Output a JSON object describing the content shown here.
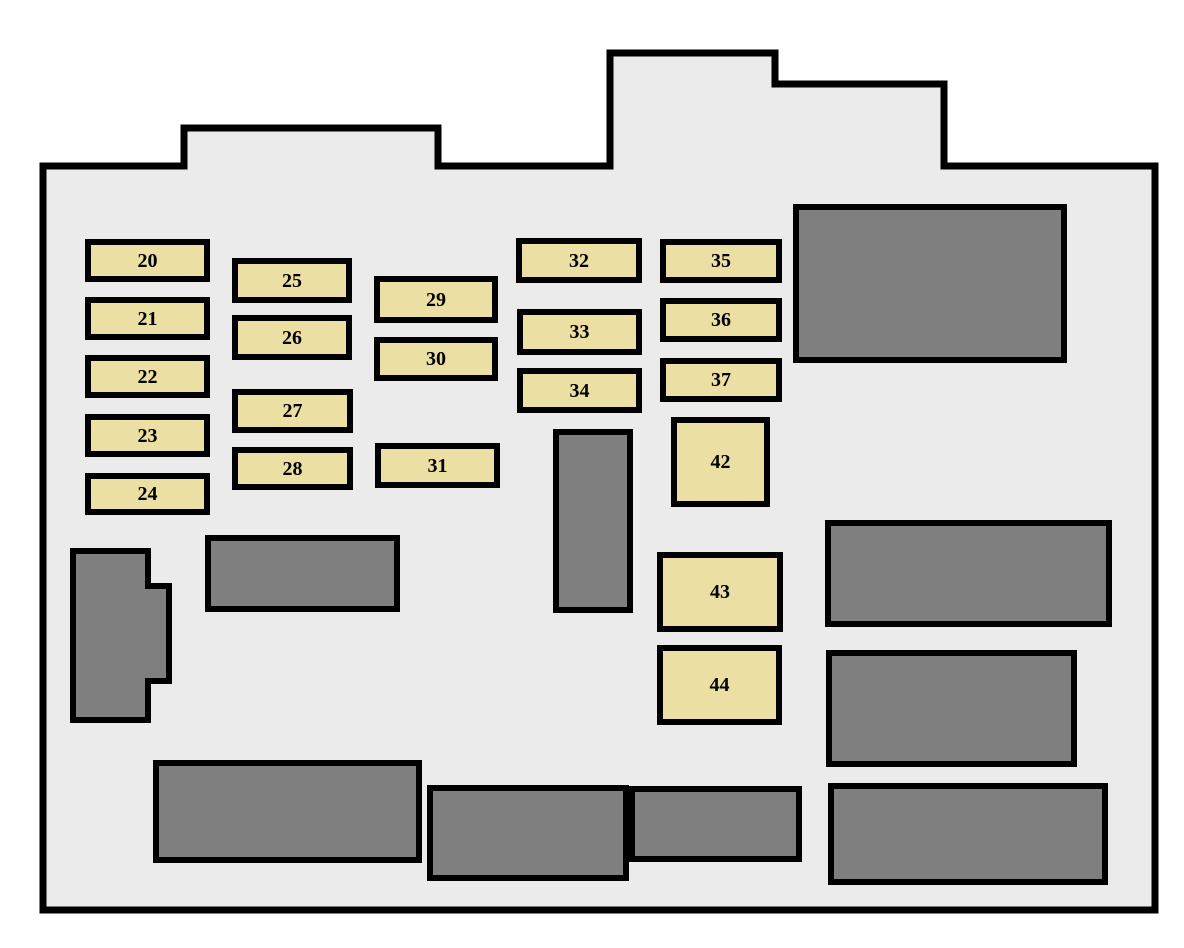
{
  "diagram": {
    "kind": "fuse-relay-box-diagram"
  },
  "colors": {
    "background": "#ffffff",
    "panel_fill": "#ebebeb",
    "outline_stroke": "#000000",
    "fuse_fill": "#ecdfa3",
    "fuse_border": "#000000",
    "relay_fill": "#7f7f7f",
    "relay_border": "#000000",
    "label_color": "#000000"
  },
  "panel_outline": {
    "points": "43,166 184,166 184,128 438,128 438,166 610,166 610,53 775,53 775,84 944,84 944,166 1155,166 1155,910 43,910",
    "stroke_width": 7
  },
  "relay_polygon": {
    "points": "73,551 148,551 148,586 169,586 169,681 148,681 148,720 73,720",
    "stroke_width": 6
  },
  "fuses": [
    {
      "label": "20",
      "x": 85,
      "y": 239,
      "w": 125,
      "h": 43
    },
    {
      "label": "21",
      "x": 85,
      "y": 297,
      "w": 125,
      "h": 43
    },
    {
      "label": "22",
      "x": 85,
      "y": 355,
      "w": 125,
      "h": 43
    },
    {
      "label": "23",
      "x": 85,
      "y": 414,
      "w": 125,
      "h": 43
    },
    {
      "label": "24",
      "x": 85,
      "y": 473,
      "w": 125,
      "h": 42
    },
    {
      "label": "25",
      "x": 232,
      "y": 258,
      "w": 120,
      "h": 45
    },
    {
      "label": "26",
      "x": 232,
      "y": 315,
      "w": 120,
      "h": 45
    },
    {
      "label": "27",
      "x": 232,
      "y": 389,
      "w": 121,
      "h": 44
    },
    {
      "label": "28",
      "x": 232,
      "y": 447,
      "w": 121,
      "h": 43
    },
    {
      "label": "29",
      "x": 374,
      "y": 276,
      "w": 124,
      "h": 47
    },
    {
      "label": "30",
      "x": 374,
      "y": 337,
      "w": 124,
      "h": 44
    },
    {
      "label": "31",
      "x": 375,
      "y": 443,
      "w": 125,
      "h": 45
    },
    {
      "label": "32",
      "x": 516,
      "y": 238,
      "w": 126,
      "h": 45
    },
    {
      "label": "33",
      "x": 517,
      "y": 309,
      "w": 125,
      "h": 46
    },
    {
      "label": "34",
      "x": 517,
      "y": 368,
      "w": 125,
      "h": 45
    },
    {
      "label": "35",
      "x": 660,
      "y": 239,
      "w": 122,
      "h": 44
    },
    {
      "label": "36",
      "x": 660,
      "y": 298,
      "w": 122,
      "h": 44
    },
    {
      "label": "37",
      "x": 660,
      "y": 358,
      "w": 122,
      "h": 44
    },
    {
      "label": "42",
      "x": 671,
      "y": 417,
      "w": 99,
      "h": 90
    },
    {
      "label": "43",
      "x": 657,
      "y": 552,
      "w": 126,
      "h": 80
    },
    {
      "label": "44",
      "x": 657,
      "y": 645,
      "w": 125,
      "h": 80
    }
  ],
  "relays": [
    {
      "x": 205,
      "y": 535,
      "w": 195,
      "h": 77
    },
    {
      "x": 553,
      "y": 429,
      "w": 80,
      "h": 184
    },
    {
      "x": 793,
      "y": 204,
      "w": 274,
      "h": 159
    },
    {
      "x": 825,
      "y": 520,
      "w": 287,
      "h": 107
    },
    {
      "x": 826,
      "y": 650,
      "w": 251,
      "h": 117
    },
    {
      "x": 828,
      "y": 783,
      "w": 280,
      "h": 102
    },
    {
      "x": 153,
      "y": 760,
      "w": 269,
      "h": 103
    },
    {
      "x": 427,
      "y": 785,
      "w": 202,
      "h": 96
    },
    {
      "x": 629,
      "y": 786,
      "w": 173,
      "h": 76
    }
  ]
}
